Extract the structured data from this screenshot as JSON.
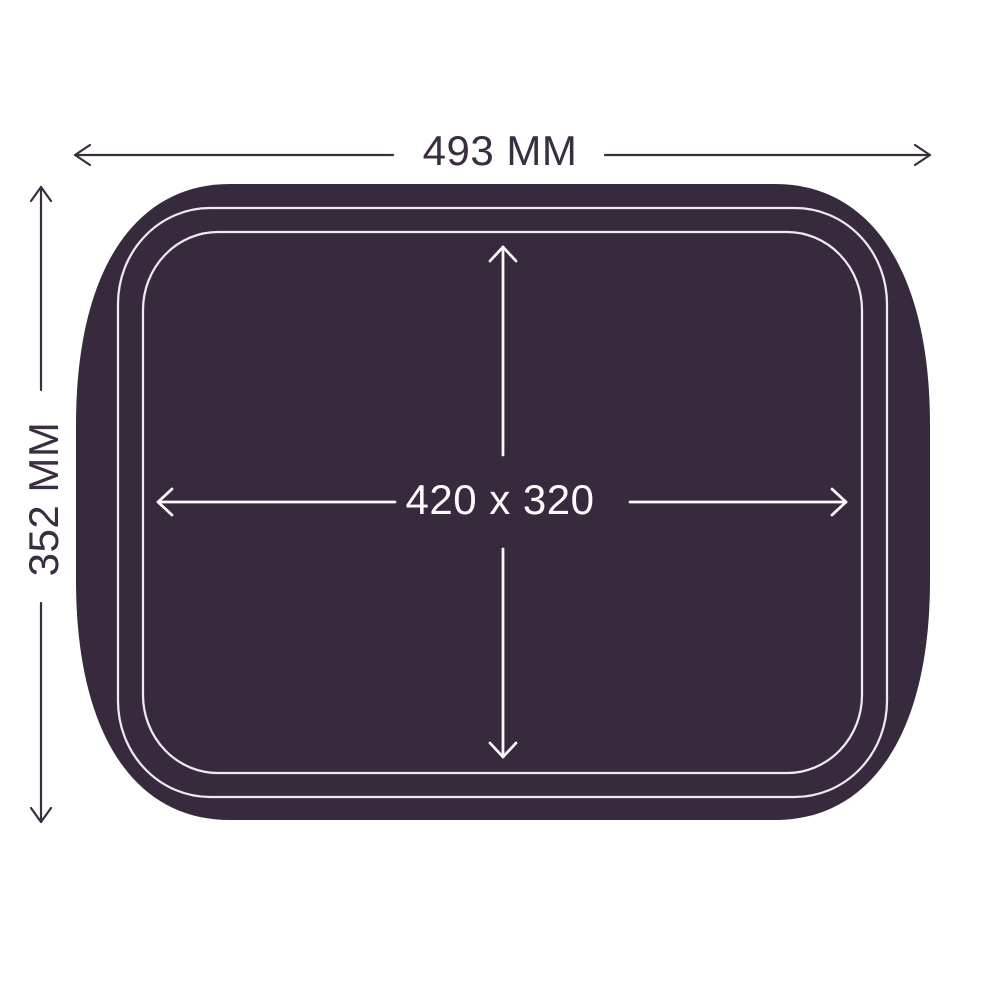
{
  "diagram": {
    "name": "tray-top-view-dimension-diagram",
    "outer_width_label": "493 MM",
    "outer_height_label": "352 MM",
    "inner_size_label": "420 x 320"
  },
  "colors": {
    "background": "#ffffff",
    "tray_fill": "#372a3c",
    "dimension_line": "#3a2d40",
    "dimension_text": "#3a2d40",
    "rim_outline": "#efeaf1",
    "inner_line": "#fdfcfd",
    "inner_text": "#fdfcfd"
  }
}
